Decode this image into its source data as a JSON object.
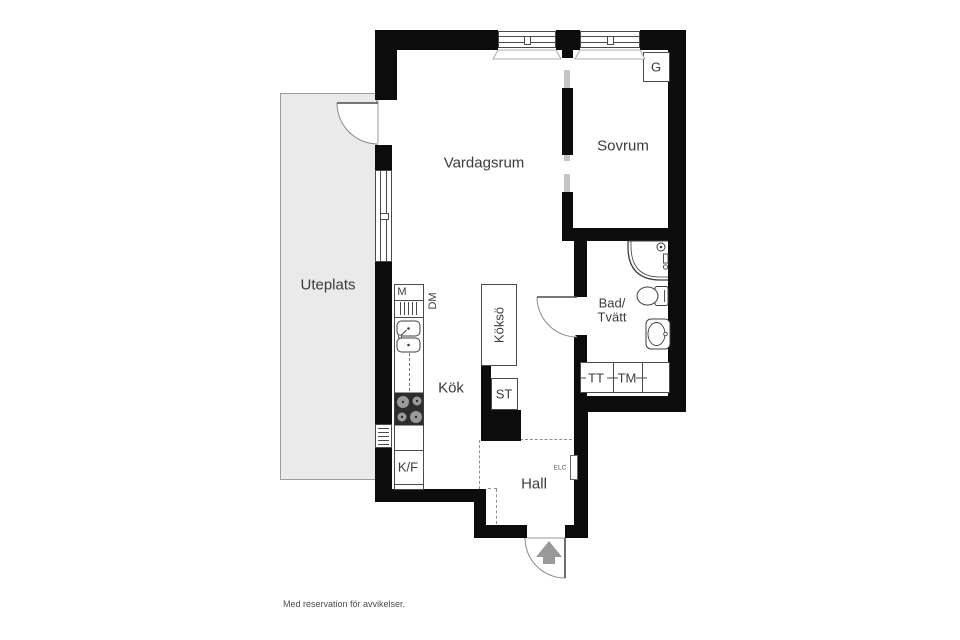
{
  "rooms": {
    "living": "Vardagsrum",
    "bedroom": "Sovrum",
    "patio": "Uteplats",
    "kitchen": "Kök",
    "hall": "Hall",
    "bath_line1": "Bad/",
    "bath_line2": "Tvätt"
  },
  "labels": {
    "wardrobe": "G",
    "kitchen_island": "Köksö",
    "cleaning_closet": "ST",
    "microwave": "M",
    "dishwasher": "DM",
    "fridge_freezer": "K/F",
    "dryer": "TT",
    "washing_machine": "TM",
    "electrical_cabinet": "ELC"
  },
  "footer": {
    "disclaimer": "Med reservation för avvikelser."
  },
  "colors": {
    "wall": "#0c0c0c",
    "patio_fill": "#eaeaea",
    "fixture_line": "#3f3f3f",
    "entry_arrow": "#999999",
    "text": "#3b3b3b"
  }
}
